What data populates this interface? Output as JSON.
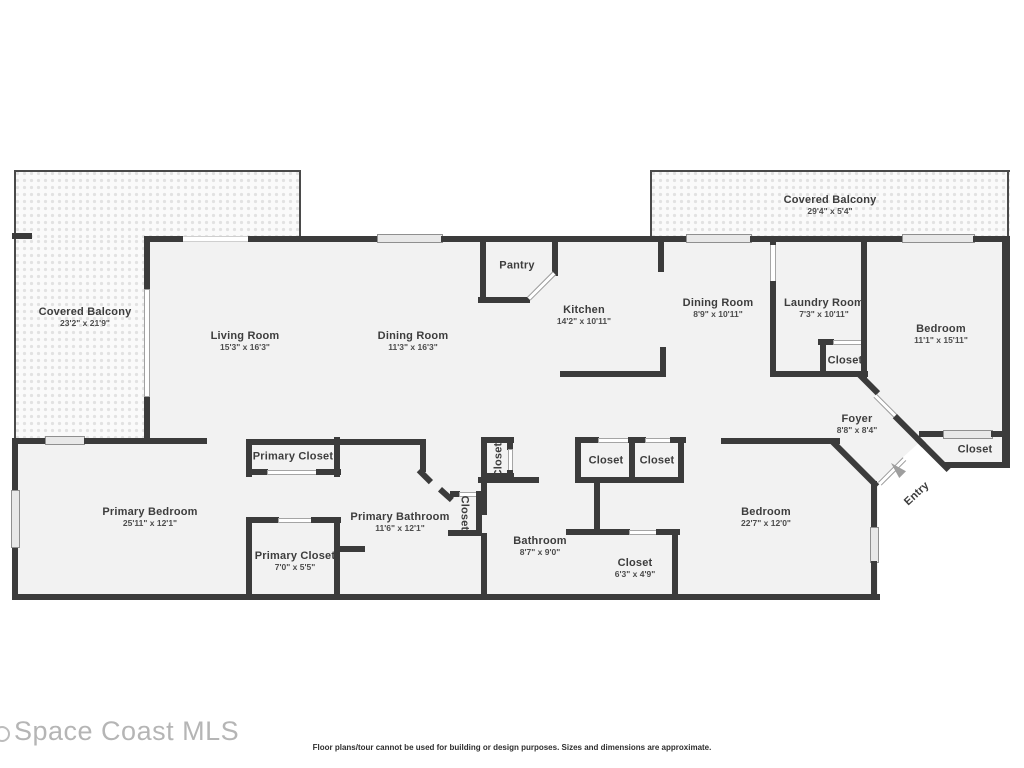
{
  "colors": {
    "wall": "#3b3b3b",
    "room_fill": "#f2f2f2",
    "balcony_fill": "#fafafa",
    "window_fill": "#e8e8e8",
    "entry_arrow": "#9e9e9e",
    "watermark": "#b5b5b5",
    "label": "#3d3d3d"
  },
  "watermark": {
    "text": "Space Coast MLS"
  },
  "footer": {
    "disclaimer": "Floor plans/tour cannot be used for building or design purposes. Sizes and dimensions are approximate."
  },
  "rooms": [
    {
      "id": "covered-balcony-left",
      "name": "Covered Balcony",
      "dims": "23'2\" x 21'9\"",
      "x": 85,
      "y": 317
    },
    {
      "id": "living-room",
      "name": "Living Room",
      "dims": "15'3\" x 16'3\"",
      "x": 245,
      "y": 341
    },
    {
      "id": "dining-room",
      "name": "Dining Room",
      "dims": "11'3\" x 16'3\"",
      "x": 413,
      "y": 341
    },
    {
      "id": "pantry",
      "name": "Pantry",
      "x": 517,
      "y": 266
    },
    {
      "id": "kitchen",
      "name": "Kitchen",
      "dims": "14'2\" x 10'11\"",
      "x": 584,
      "y": 315
    },
    {
      "id": "dining-room-2",
      "name": "Dining Room",
      "dims": "8'9\" x 10'11\"",
      "x": 718,
      "y": 308
    },
    {
      "id": "covered-balcony-right",
      "name": "Covered Balcony",
      "dims": "29'4\" x 5'4\"",
      "x": 830,
      "y": 205
    },
    {
      "id": "laundry-room",
      "name": "Laundry Room",
      "dims": "7'3\" x 10'11\"",
      "x": 824,
      "y": 308
    },
    {
      "id": "laundry-closet",
      "name": "Closet",
      "x": 845,
      "y": 361
    },
    {
      "id": "bedroom-top-right",
      "name": "Bedroom",
      "dims": "11'1\" x 15'11\"",
      "x": 941,
      "y": 334
    },
    {
      "id": "foyer",
      "name": "Foyer",
      "dims": "8'8\" x 8'4\"",
      "x": 857,
      "y": 424
    },
    {
      "id": "closet-right",
      "name": "Closet",
      "x": 975,
      "y": 450
    },
    {
      "id": "entry",
      "name": "Entry",
      "x": 917,
      "y": 494,
      "rot": -43
    },
    {
      "id": "primary-bedroom",
      "name": "Primary Bedroom",
      "dims": "25'11\" x 12'1\"",
      "x": 150,
      "y": 517
    },
    {
      "id": "primary-closet-top",
      "name": "Primary Closet",
      "x": 293,
      "y": 457
    },
    {
      "id": "primary-closet-bottom",
      "name": "Primary Closet",
      "dims": "7'0\" x 5'5\"",
      "x": 295,
      "y": 561
    },
    {
      "id": "primary-bathroom",
      "name": "Primary Bathroom",
      "dims": "11'6\" x 12'1\"",
      "x": 400,
      "y": 522
    },
    {
      "id": "closet-hall",
      "name": "Closet",
      "x": 499,
      "y": 460,
      "rot": -90
    },
    {
      "id": "closet-bath",
      "name": "Closet",
      "x": 464,
      "y": 513,
      "rot": 90
    },
    {
      "id": "closet-a",
      "name": "Closet",
      "x": 606,
      "y": 461
    },
    {
      "id": "closet-b",
      "name": "Closet",
      "x": 657,
      "y": 461
    },
    {
      "id": "bathroom",
      "name": "Bathroom",
      "dims": "8'7\" x 9'0\"",
      "x": 540,
      "y": 546
    },
    {
      "id": "closet-bedroom",
      "name": "Closet",
      "dims": "6'3\" x 4'9\"",
      "x": 635,
      "y": 568
    },
    {
      "id": "bedroom-bottom",
      "name": "Bedroom",
      "dims": "22'7\" x 12'0\"",
      "x": 766,
      "y": 517
    }
  ]
}
